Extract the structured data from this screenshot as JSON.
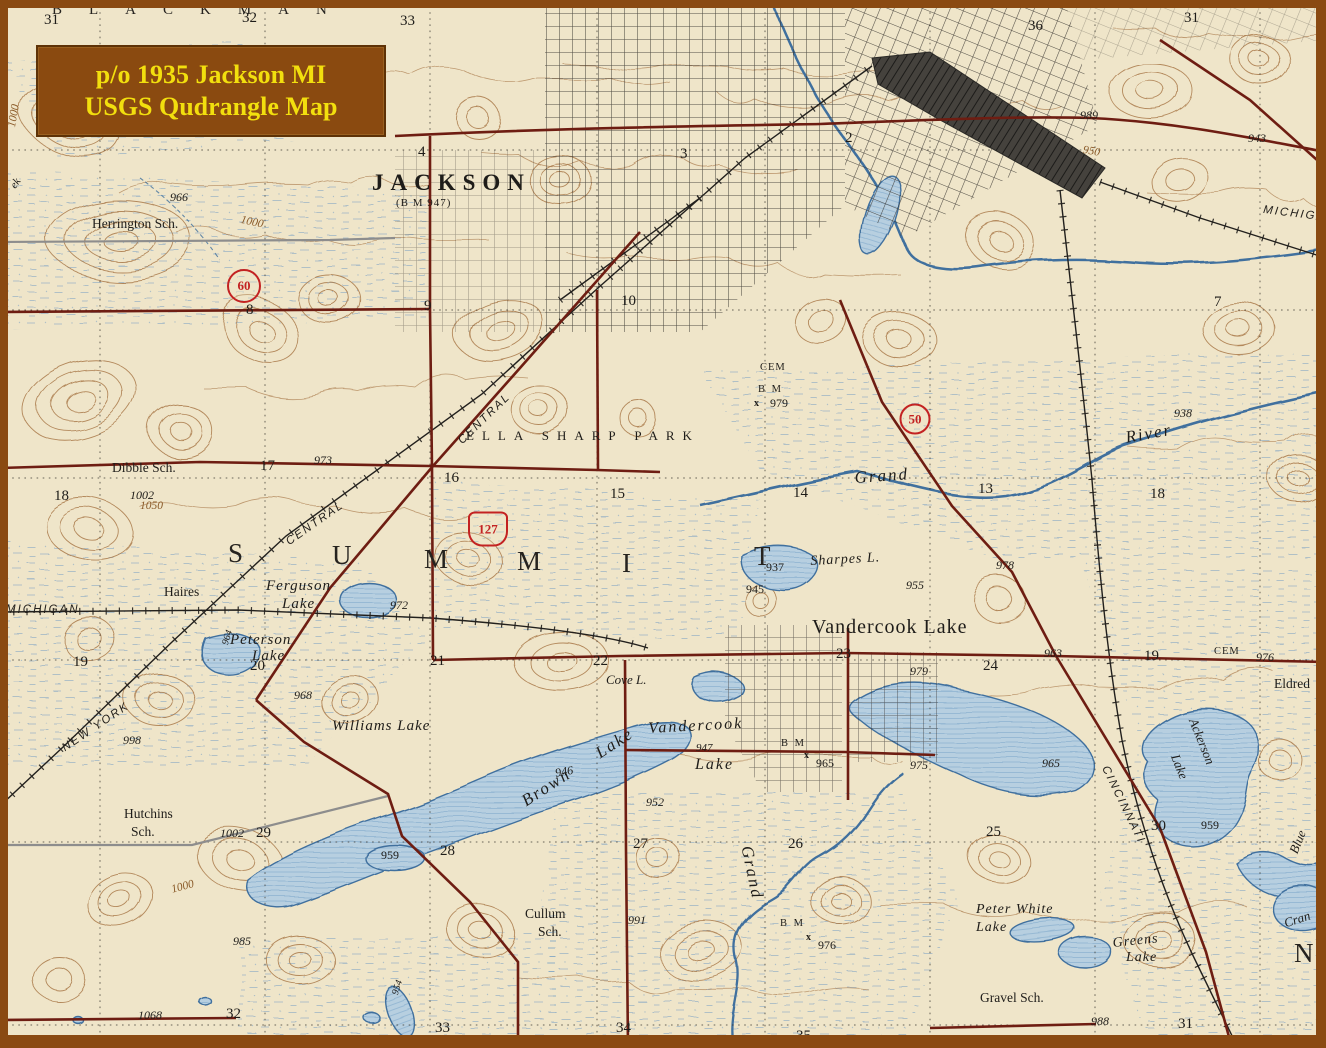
{
  "title_box": {
    "line1": "p/o 1935 Jackson MI",
    "line2": "USGS Qudrangle Map"
  },
  "colors": {
    "paper": "#efe5c9",
    "contour": "#a87848",
    "waterline": "#3f6f9e",
    "waterfill": "#b7cfe0",
    "marsh": "#6f9cc4",
    "road": "#6e1d12",
    "roadgray": "#8d8d8d",
    "rail": "#22201d",
    "ink": "#1e1c19",
    "shield": "#c32222",
    "titlebg": "#8a4a10",
    "titletext": "#f2df0e",
    "border": "#8a4a12"
  },
  "shields": [
    {
      "label": "60",
      "shape": "circle",
      "x": 244,
      "y": 286,
      "w": 30,
      "h": 30
    },
    {
      "label": "127",
      "shape": "us",
      "x": 488,
      "y": 529,
      "w": 36,
      "h": 31
    },
    {
      "label": "50",
      "shape": "circle",
      "x": 915,
      "y": 419,
      "w": 27,
      "h": 27
    }
  ],
  "labels": [
    {
      "t": "BLACKMAN",
      "x": 52,
      "y": 2,
      "k": "twpS",
      "n": "township-label-blackman"
    },
    {
      "t": "S",
      "x": 228,
      "y": 538,
      "k": "twpL",
      "n": "township-letter-summit-s"
    },
    {
      "t": "U",
      "x": 332,
      "y": 540,
      "k": "twpL",
      "n": "township-letter-summit-u"
    },
    {
      "t": "M",
      "x": 424,
      "y": 544,
      "k": "twpL",
      "n": "township-letter-summit-m1"
    },
    {
      "t": "M",
      "x": 517,
      "y": 546,
      "k": "twpL",
      "n": "township-letter-summit-m2"
    },
    {
      "t": "I",
      "x": 622,
      "y": 548,
      "k": "twpL",
      "n": "township-letter-summit-i"
    },
    {
      "t": "T",
      "x": 754,
      "y": 541,
      "k": "twpL",
      "n": "township-letter-summit-t"
    },
    {
      "t": "N",
      "x": 1294,
      "y": 938,
      "k": "twpL",
      "n": "township-letter-clipped"
    },
    {
      "t": "JACKSON",
      "x": 372,
      "y": 170,
      "k": "city",
      "n": "city-label-jackson"
    },
    {
      "t": "(B M 947)",
      "x": 396,
      "y": 197,
      "k": "note",
      "n": "benchmark-jackson"
    },
    {
      "t": "Vandercook Lake",
      "x": 812,
      "y": 616,
      "k": "town",
      "n": "town-label-vandercook-lake"
    },
    {
      "t": "ELLA SHARP PARK",
      "x": 466,
      "y": 428,
      "k": "park",
      "n": "park-label-ella-sharp-park"
    },
    {
      "t": "CENTRAL",
      "x": 456,
      "y": 438,
      "k": "rail",
      "r": -44,
      "n": "railroad-label-central-1"
    },
    {
      "t": "CENTRAL",
      "x": 284,
      "y": 538,
      "k": "rail",
      "r": -35,
      "n": "railroad-label-central-2"
    },
    {
      "t": "NEW YORK",
      "x": 60,
      "y": 744,
      "k": "rail",
      "r": -34,
      "n": "railroad-label-new-york"
    },
    {
      "t": "MICHIGAN",
      "x": 6,
      "y": 604,
      "k": "rail",
      "n": "railroad-label-michigan-west"
    },
    {
      "t": "MICHIGAN",
      "x": 1264,
      "y": 204,
      "k": "rail",
      "r": 7,
      "n": "railroad-label-michigan-east"
    },
    {
      "t": "CINCINNATI",
      "x": 1110,
      "y": 764,
      "k": "rail",
      "r": 64,
      "n": "railroad-label-cincinnati"
    },
    {
      "t": "Grand",
      "x": 854,
      "y": 468,
      "k": "riv",
      "r": -4,
      "n": "river-label-grand-1"
    },
    {
      "t": "River",
      "x": 1124,
      "y": 428,
      "k": "riv",
      "r": -10,
      "n": "river-label-river"
    },
    {
      "t": "Grand",
      "x": 756,
      "y": 844,
      "k": "riv",
      "r": 78,
      "n": "river-label-grand-2"
    },
    {
      "t": "ek",
      "x": 8,
      "y": 184,
      "k": "riv11",
      "r": -55,
      "n": "creek-label-fragment"
    },
    {
      "t": "Blue",
      "x": 1286,
      "y": 850,
      "k": "riv13",
      "r": -68,
      "n": "lake-label-blue-fragment"
    },
    {
      "t": "Cran",
      "x": 1282,
      "y": 916,
      "k": "riv13",
      "r": -18,
      "n": "lake-label-cran-fragment"
    },
    {
      "t": "Ferguson",
      "x": 266,
      "y": 578,
      "k": "lk15",
      "n": "lake-label-ferguson"
    },
    {
      "t": "Lake",
      "x": 282,
      "y": 596,
      "k": "lk15",
      "n": "lake-label-ferguson-2"
    },
    {
      "t": "Peterson",
      "x": 230,
      "y": 632,
      "k": "lk15",
      "n": "lake-label-peterson"
    },
    {
      "t": "Lake",
      "x": 252,
      "y": 648,
      "k": "lk15",
      "n": "lake-label-peterson-2"
    },
    {
      "t": "Williams Lake",
      "x": 332,
      "y": 718,
      "k": "lk15",
      "n": "lake-label-williams"
    },
    {
      "t": "Brown",
      "x": 518,
      "y": 794,
      "k": "lk17",
      "r": -33,
      "n": "lake-label-brown"
    },
    {
      "t": "Lake",
      "x": 592,
      "y": 746,
      "k": "lk17",
      "r": -33,
      "n": "lake-label-brown-2"
    },
    {
      "t": "Vandercook",
      "x": 648,
      "y": 720,
      "k": "lk16",
      "r": -3,
      "n": "lake-label-vandercook"
    },
    {
      "t": "947",
      "x": 696,
      "y": 742,
      "k": "ei11",
      "n": "elevation-947"
    },
    {
      "t": "Lake",
      "x": 695,
      "y": 756,
      "k": "lk16",
      "n": "lake-label-vandercook-2"
    },
    {
      "t": "Cove L.",
      "x": 606,
      "y": 672,
      "k": "lk13",
      "n": "lake-label-cove"
    },
    {
      "t": "Sharpes L.",
      "x": 810,
      "y": 554,
      "k": "lk14",
      "r": -3,
      "n": "lake-label-sharpes"
    },
    {
      "t": "Ackerson",
      "x": 1200,
      "y": 716,
      "k": "lk13",
      "r": 68,
      "n": "lake-label-ackerson"
    },
    {
      "t": "Lake",
      "x": 1182,
      "y": 752,
      "k": "lk13",
      "r": 68,
      "n": "lake-label-ackerson-2"
    },
    {
      "t": "Peter White",
      "x": 976,
      "y": 902,
      "k": "lk14",
      "n": "lake-label-peter-white"
    },
    {
      "t": "Lake",
      "x": 976,
      "y": 920,
      "k": "lk14",
      "n": "lake-label-peter-white-2"
    },
    {
      "t": "Greens",
      "x": 1112,
      "y": 936,
      "k": "lk14",
      "r": -6,
      "n": "lake-label-greens"
    },
    {
      "t": "Lake",
      "x": 1126,
      "y": 950,
      "k": "lk14",
      "n": "lake-label-greens-2"
    },
    {
      "t": "Herrington Sch.",
      "x": 92,
      "y": 216,
      "k": "sch",
      "n": "school-label-herrington"
    },
    {
      "t": "Dibble Sch.",
      "x": 112,
      "y": 460,
      "k": "sch",
      "n": "school-label-dibble"
    },
    {
      "t": "Haires",
      "x": 164,
      "y": 584,
      "k": "sch",
      "n": "station-label-haires"
    },
    {
      "t": "Hutchins",
      "x": 124,
      "y": 806,
      "k": "sch",
      "n": "school-label-hutchins"
    },
    {
      "t": "Sch.",
      "x": 131,
      "y": 824,
      "k": "sch",
      "n": "school-label-hutchins-2"
    },
    {
      "t": "Cullum",
      "x": 525,
      "y": 906,
      "k": "sch",
      "n": "school-label-cullum"
    },
    {
      "t": "Sch.",
      "x": 538,
      "y": 924,
      "k": "sch",
      "n": "school-label-cullum-2"
    },
    {
      "t": "Gravel Sch.",
      "x": 980,
      "y": 990,
      "k": "sch",
      "n": "school-label-gravel"
    },
    {
      "t": "Eldred",
      "x": 1274,
      "y": 676,
      "k": "sch",
      "n": "place-label-eldred"
    },
    {
      "t": "CEM",
      "x": 760,
      "y": 362,
      "k": "cem",
      "n": "cemetery-label-1"
    },
    {
      "t": "CEM",
      "x": 1214,
      "y": 646,
      "k": "cem",
      "n": "cemetery-label-2"
    },
    {
      "t": "B M",
      "x": 758,
      "y": 384,
      "k": "bm",
      "n": "benchmark-1"
    },
    {
      "t": "979",
      "x": 770,
      "y": 396,
      "k": "e",
      "n": "elevation-979-bm"
    },
    {
      "t": "x",
      "x": 754,
      "y": 398,
      "k": "bmx",
      "n": "benchmark-cross-1"
    },
    {
      "t": "B M",
      "x": 781,
      "y": 738,
      "k": "bm",
      "n": "benchmark-2"
    },
    {
      "t": "x",
      "x": 804,
      "y": 750,
      "k": "bmx",
      "n": "benchmark-cross-2"
    },
    {
      "t": "965",
      "x": 816,
      "y": 756,
      "k": "e",
      "n": "elevation-965-bm"
    },
    {
      "t": "B M",
      "x": 780,
      "y": 918,
      "k": "bm",
      "n": "benchmark-3"
    },
    {
      "t": "x",
      "x": 806,
      "y": 932,
      "k": "bmx",
      "n": "benchmark-cross-3"
    },
    {
      "t": "976",
      "x": 818,
      "y": 938,
      "k": "e",
      "n": "elevation-976-bm"
    },
    {
      "t": "31",
      "x": 44,
      "y": 12,
      "k": "sec"
    },
    {
      "t": "32",
      "x": 242,
      "y": 10,
      "k": "sec"
    },
    {
      "t": "33",
      "x": 400,
      "y": 13,
      "k": "sec"
    },
    {
      "t": "36",
      "x": 1028,
      "y": 18,
      "k": "sec"
    },
    {
      "t": "31",
      "x": 1184,
      "y": 10,
      "k": "sec"
    },
    {
      "t": "2",
      "x": 845,
      "y": 130,
      "k": "sec"
    },
    {
      "t": "4",
      "x": 418,
      "y": 144,
      "k": "sec"
    },
    {
      "t": "3",
      "x": 680,
      "y": 146,
      "k": "sec"
    },
    {
      "t": "8",
      "x": 246,
      "y": 302,
      "k": "sec"
    },
    {
      "t": "9",
      "x": 424,
      "y": 298,
      "k": "sec"
    },
    {
      "t": "10",
      "x": 621,
      "y": 293,
      "k": "sec"
    },
    {
      "t": "7",
      "x": 1214,
      "y": 294,
      "k": "sec"
    },
    {
      "t": "18",
      "x": 54,
      "y": 488,
      "k": "sec"
    },
    {
      "t": "17",
      "x": 260,
      "y": 458,
      "k": "sec"
    },
    {
      "t": "16",
      "x": 444,
      "y": 470,
      "k": "sec"
    },
    {
      "t": "15",
      "x": 610,
      "y": 486,
      "k": "sec"
    },
    {
      "t": "14",
      "x": 793,
      "y": 485,
      "k": "sec"
    },
    {
      "t": "13",
      "x": 978,
      "y": 481,
      "k": "sec"
    },
    {
      "t": "18",
      "x": 1150,
      "y": 486,
      "k": "sec"
    },
    {
      "t": "19",
      "x": 73,
      "y": 654,
      "k": "sec"
    },
    {
      "t": "20",
      "x": 250,
      "y": 658,
      "k": "sec"
    },
    {
      "t": "21",
      "x": 430,
      "y": 653,
      "k": "sec"
    },
    {
      "t": "22",
      "x": 593,
      "y": 653,
      "k": "sec"
    },
    {
      "t": "23",
      "x": 836,
      "y": 646,
      "k": "sec"
    },
    {
      "t": "24",
      "x": 983,
      "y": 658,
      "k": "sec"
    },
    {
      "t": "19",
      "x": 1144,
      "y": 648,
      "k": "sec"
    },
    {
      "t": "25",
      "x": 986,
      "y": 824,
      "k": "sec"
    },
    {
      "t": "26",
      "x": 788,
      "y": 836,
      "k": "sec"
    },
    {
      "t": "27",
      "x": 633,
      "y": 836,
      "k": "sec"
    },
    {
      "t": "28",
      "x": 440,
      "y": 843,
      "k": "sec"
    },
    {
      "t": "29",
      "x": 256,
      "y": 825,
      "k": "sec"
    },
    {
      "t": "30",
      "x": 1151,
      "y": 818,
      "k": "sec"
    },
    {
      "t": "32",
      "x": 226,
      "y": 1006,
      "k": "sec"
    },
    {
      "t": "33",
      "x": 435,
      "y": 1020,
      "k": "sec"
    },
    {
      "t": "34",
      "x": 616,
      "y": 1020,
      "k": "sec"
    },
    {
      "t": "35",
      "x": 796,
      "y": 1028,
      "k": "sec"
    },
    {
      "t": "31",
      "x": 1178,
      "y": 1016,
      "k": "sec"
    },
    {
      "t": "966",
      "x": 170,
      "y": 190,
      "k": "ei"
    },
    {
      "t": "973",
      "x": 314,
      "y": 453,
      "k": "ei"
    },
    {
      "t": "1002",
      "x": 130,
      "y": 488,
      "k": "ei"
    },
    {
      "t": "998",
      "x": 123,
      "y": 733,
      "k": "ei"
    },
    {
      "t": "968",
      "x": 294,
      "y": 688,
      "k": "ei"
    },
    {
      "t": "972",
      "x": 390,
      "y": 598,
      "k": "ei"
    },
    {
      "t": "937",
      "x": 766,
      "y": 560,
      "k": "e"
    },
    {
      "t": "945",
      "x": 746,
      "y": 582,
      "k": "e"
    },
    {
      "t": "955",
      "x": 906,
      "y": 578,
      "k": "ei"
    },
    {
      "t": "978",
      "x": 996,
      "y": 558,
      "k": "ei"
    },
    {
      "t": "963",
      "x": 1044,
      "y": 646,
      "k": "ei"
    },
    {
      "t": "979",
      "x": 910,
      "y": 664,
      "k": "ei"
    },
    {
      "t": "975",
      "x": 910,
      "y": 758,
      "k": "ei"
    },
    {
      "t": "965",
      "x": 1042,
      "y": 756,
      "k": "ei"
    },
    {
      "t": "989",
      "x": 1080,
      "y": 108,
      "k": "ei"
    },
    {
      "t": "943",
      "x": 1248,
      "y": 131,
      "k": "ei"
    },
    {
      "t": "938",
      "x": 1174,
      "y": 406,
      "k": "ei"
    },
    {
      "t": "946",
      "x": 554,
      "y": 766,
      "k": "ei",
      "r": -10
    },
    {
      "t": "952",
      "x": 646,
      "y": 795,
      "k": "ei"
    },
    {
      "t": "991",
      "x": 628,
      "y": 913,
      "k": "ei"
    },
    {
      "t": "985",
      "x": 233,
      "y": 934,
      "k": "ei"
    },
    {
      "t": "988",
      "x": 1091,
      "y": 1014,
      "k": "ei"
    },
    {
      "t": "1068",
      "x": 138,
      "y": 1008,
      "k": "ei"
    },
    {
      "t": "1002",
      "x": 220,
      "y": 826,
      "k": "ei"
    },
    {
      "t": "959",
      "x": 381,
      "y": 848,
      "k": "e"
    },
    {
      "t": "959",
      "x": 1201,
      "y": 818,
      "k": "e"
    },
    {
      "t": "976",
      "x": 1256,
      "y": 650,
      "k": "ei"
    },
    {
      "t": "964",
      "x": 220,
      "y": 643,
      "k": "ei10",
      "r": -72
    },
    {
      "t": "954",
      "x": 390,
      "y": 993,
      "k": "ei10",
      "r": -72
    },
    {
      "t": "950",
      "x": 1084,
      "y": 144,
      "k": "cont",
      "r": 10
    },
    {
      "t": "1000",
      "x": 242,
      "y": 214,
      "k": "cont",
      "r": 12
    },
    {
      "t": "1050",
      "x": 140,
      "y": 500,
      "k": "cont"
    },
    {
      "t": "1000",
      "x": 170,
      "y": 884,
      "k": "cont",
      "r": -15
    },
    {
      "t": "1000",
      "x": 6,
      "y": 126,
      "k": "cont",
      "r": -80
    }
  ]
}
